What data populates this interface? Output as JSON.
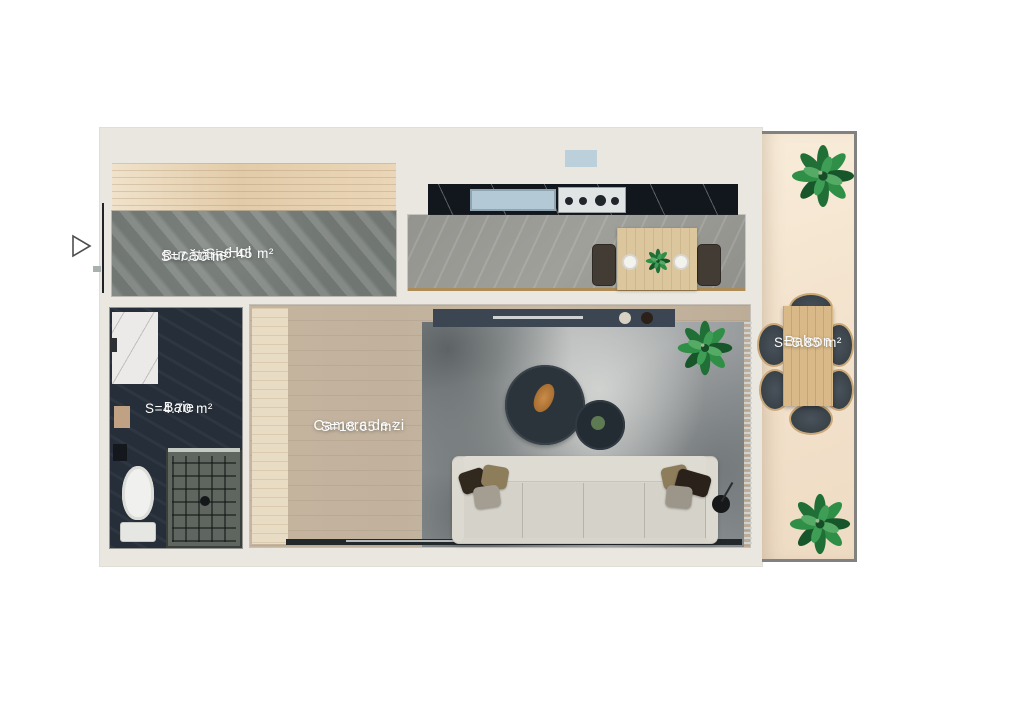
{
  "rooms": [
    {
      "id": "hol",
      "name": "Hol",
      "area": "S=6.45 m²"
    },
    {
      "id": "bucatarie",
      "name": "Bucătărie",
      "area": "S=7.50 m²"
    },
    {
      "id": "baie",
      "name": "Baie",
      "area": "S=4.70 m²"
    },
    {
      "id": "camera_de_zi",
      "name": "Camera de zi",
      "area": "S=18.65 m²"
    },
    {
      "id": "balcon",
      "name": "Balcon",
      "area": "S=5.85 m²"
    }
  ],
  "entrance": {
    "icon": "right-pointing-triangle-arrow"
  },
  "palette": {
    "background": "#ffffff",
    "slab": "#eae7e0",
    "hol_floor": "#7d837f",
    "hol_wardrobe_wood": "#e7d3b4",
    "kitchen_floor": "#a0a09b",
    "kitchen_counter": "#12171e",
    "kitchen_sink": "#b4c9d6",
    "bath_floor": "#262e39",
    "living_floor": "#c9baa6",
    "rug": "#a7abac",
    "sofa": "#d8d5cc",
    "balcony_floor": "#f5e7d3",
    "outdoor_table": "#d9b988",
    "chair_dark": "#3a434b",
    "plant_green": "#2f8f47",
    "label_text": "#ffffff"
  }
}
